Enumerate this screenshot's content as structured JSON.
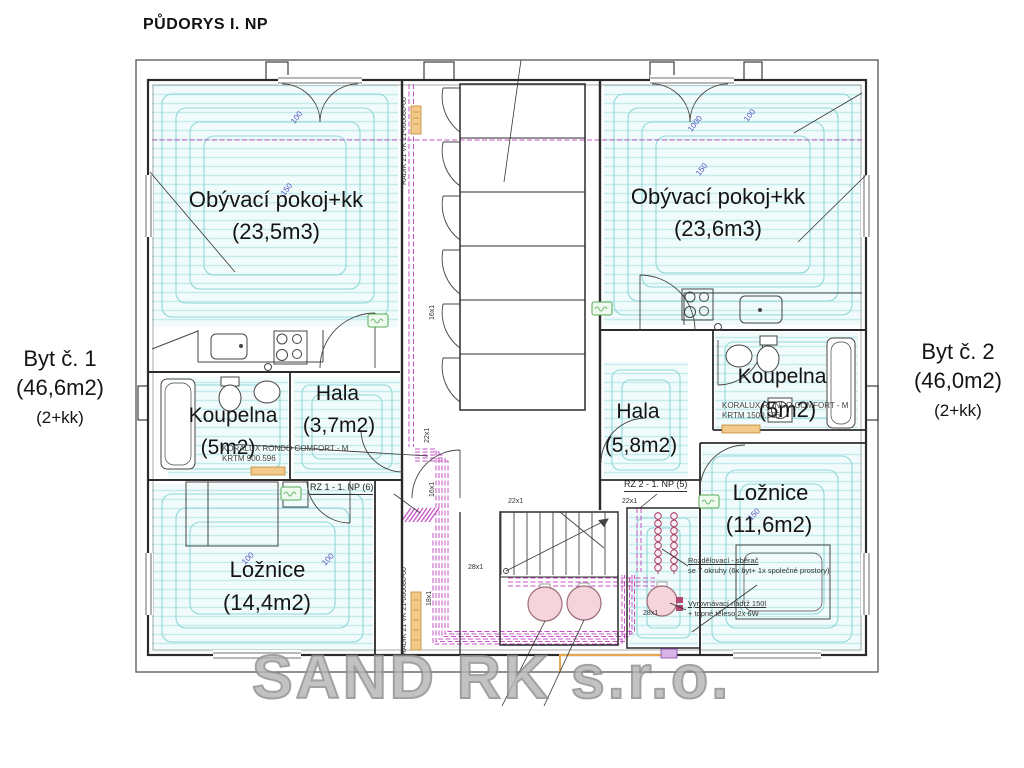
{
  "title": "PŮDORYS I. NP",
  "watermark": "SAND RK s.r.o.",
  "apartment1": {
    "name": "Byt č. 1",
    "area": "(46,6m2)",
    "disposition": "(2+kk)"
  },
  "apartment2": {
    "name": "Byt č. 2",
    "area": "(46,0m2)",
    "disposition": "(2+kk)"
  },
  "rooms": {
    "living1": {
      "name": "Obývací pokoj+kk",
      "area": "(23,5m3)"
    },
    "living2": {
      "name": "Obývací pokoj+kk",
      "area": "(23,6m3)"
    },
    "bath1": {
      "name": "Koupelna",
      "area": "(5m2)"
    },
    "hall1": {
      "name": "Hala",
      "area": "(3,7m2)"
    },
    "hall2": {
      "name": "Hala",
      "area": "(5,8m2)"
    },
    "bath2": {
      "name": "Koupelna",
      "area": "(5m2)"
    },
    "bedroom1": {
      "name": "Ložnice",
      "area": "(14,4m2)"
    },
    "bedroom2": {
      "name": "Ložnice",
      "area": "(11,6m2)"
    }
  },
  "annotations": {
    "radiator1_line1": "KORALUX RONDO COMFORT - M",
    "radiator1_line2": "KRTM 900.596",
    "radiator2_line1": "KORALUX RONDO COMFORT - M",
    "radiator2_line2": "KRTM 1500.596",
    "rz1": "RZ 1 - 1. NP (6)",
    "rz2": "RZ 2 - 1. NP (5)",
    "manifold_line1": "Rozdělovací - sběrač",
    "manifold_line2": "se 7 okruhy (6x byt+ 1x společné prostory)",
    "tank_line1": "Vyrovnávací nádrž 150l",
    "tank_line2": "+ topné těleso 2x 6W",
    "radik_top": "RADIK 21 VK 21-060080-60",
    "radik_bottom": "RADIK 21 VK 21-060080-60"
  },
  "pipes": {
    "p16a": "16x1",
    "p16b": "16x1",
    "p18": "18x1",
    "p22v": "22x1",
    "p22a": "22x1",
    "p22b": "22x1",
    "p28a": "28x1",
    "p28b": "28x1"
  },
  "dimensions": {
    "d1": "100",
    "d2": "1000",
    "d3": "100",
    "d4": "150",
    "d5": "150",
    "d6": "100",
    "d7": "100",
    "d8": "150"
  },
  "colors": {
    "heating_coil": "#8fd8d8",
    "pipe_magenta": "#c653c6",
    "tank_pink": "#f6d4dc",
    "radiator_orange": "#f3c98c",
    "thermostat_green": "#66b366",
    "dimension_blue": "#4d4dc0",
    "watermark_gray": "#9a9a9a"
  }
}
